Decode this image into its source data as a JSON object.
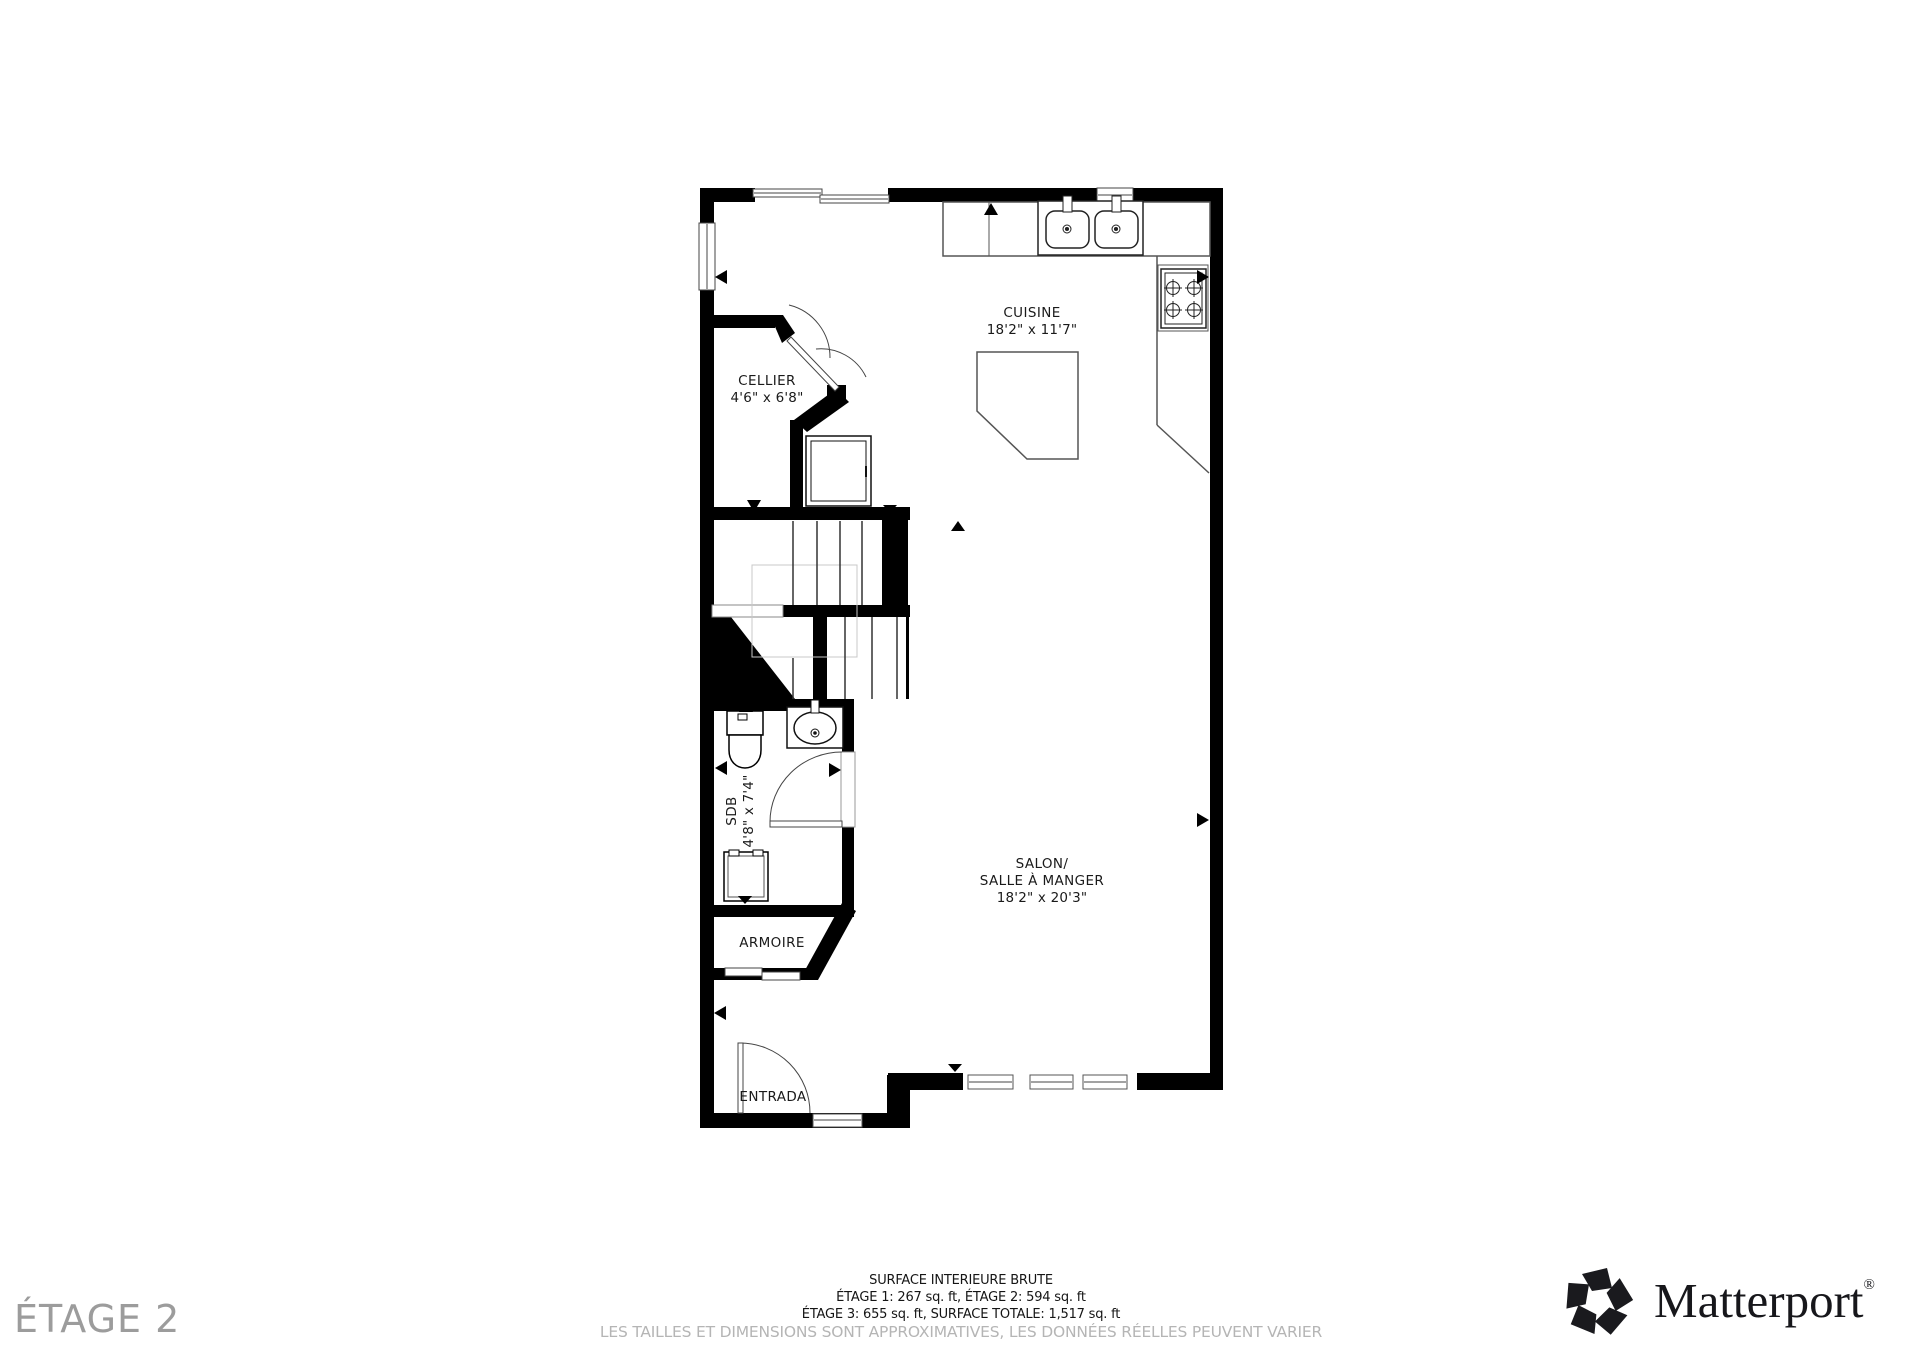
{
  "rooms": {
    "cuisine": {
      "name": "CUISINE",
      "dims": "18'2\" x 11'7\""
    },
    "cellier": {
      "name": "CELLIER",
      "dims": "4'6\" x 6'8\""
    },
    "sdb": {
      "name": "SDB",
      "dims": "4'8\" x 7'4\""
    },
    "armoire": {
      "name": "ARMOIRE"
    },
    "entrada": {
      "name": "ENTRADA"
    },
    "salon": {
      "line1": "SALON/",
      "line2": "SALLE À MANGER",
      "dims": "18'2\" x 20'3\""
    }
  },
  "footer": {
    "line1": "SURFACE INTERIEURE BRUTE",
    "line2": "ÉTAGE 1: 267 sq. ft, ÉTAGE 2: 594 sq. ft",
    "line3": "ÉTAGE 3: 655 sq. ft, SURFACE TOTALE: 1,517 sq. ft",
    "disclaimer": "LES TAILLES ET DIMENSIONS SONT APPROXIMATIVES, LES DONNÉES RÉELLES PEUVENT VARIER"
  },
  "floor_label": "ÉTAGE 2",
  "brand": {
    "name": "Matterport",
    "registered": "®"
  },
  "colors": {
    "wall": "#000000",
    "label_text": "#1a1a1a",
    "floor_label_text": "#9c9c9c",
    "disclaimer_text": "#b5b5b5",
    "fixture_line": "#555555",
    "faint_line": "#c8c8c8"
  }
}
